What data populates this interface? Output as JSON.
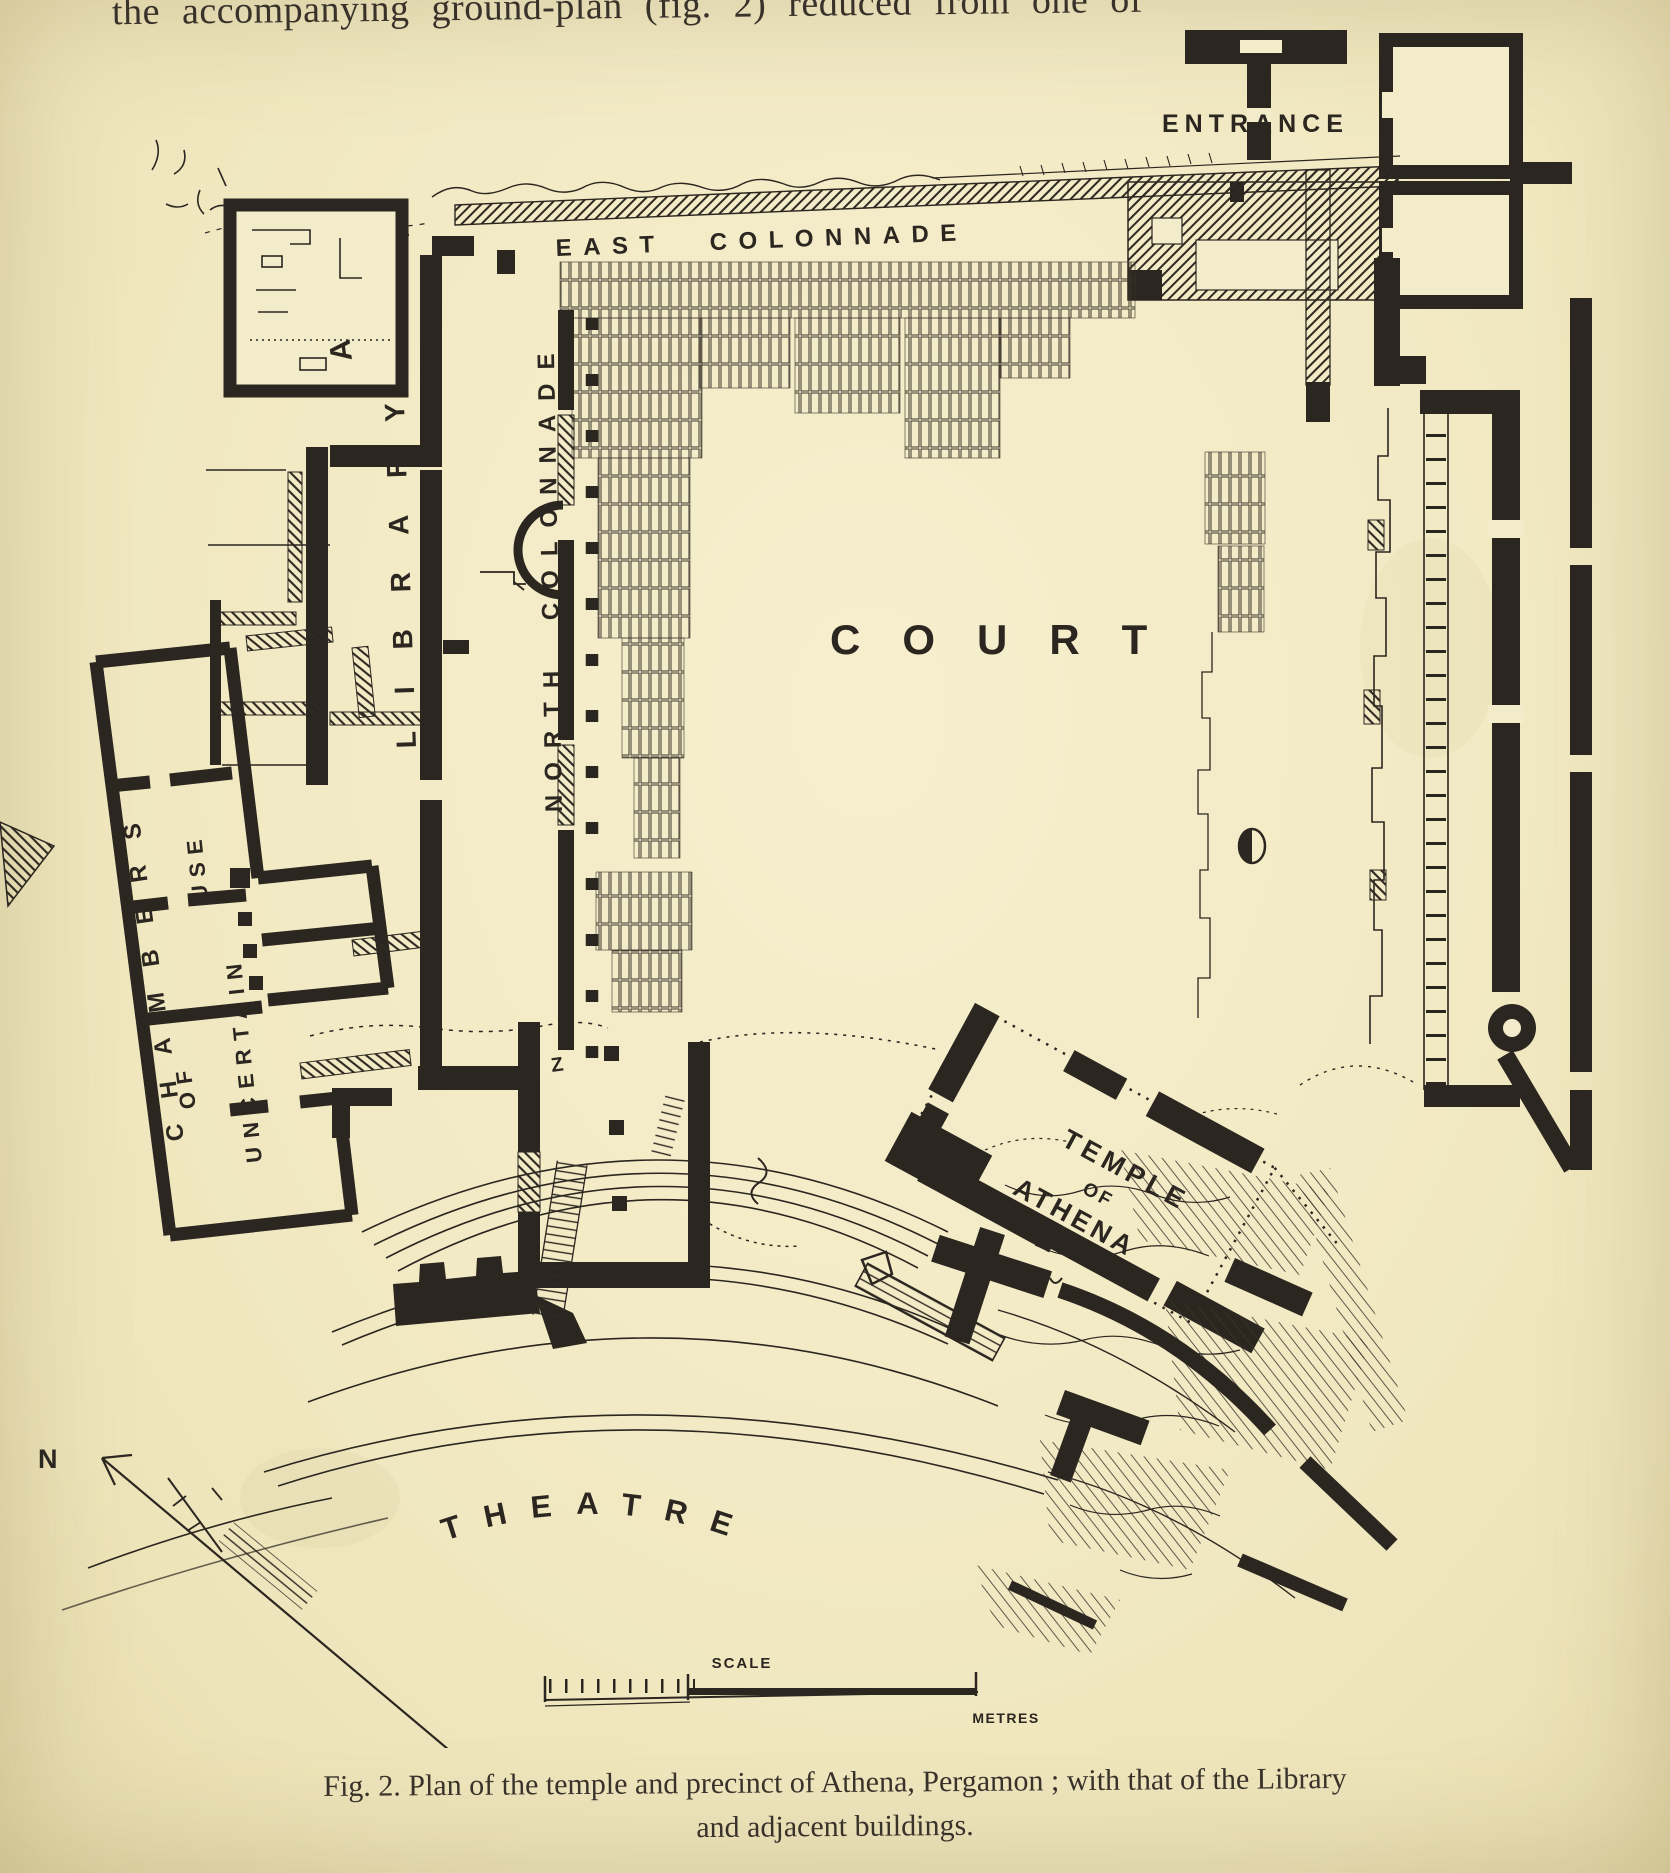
{
  "page": {
    "top_text": "the accompanying ground-plan (fig. 2) reduced from one of",
    "caption": {
      "line1": "Fig. 2.  Plan of the temple and precinct of Athena, Pergamon ; with that of the Library",
      "line2": "and adjacent buildings."
    }
  },
  "plan": {
    "labels": {
      "entrance": "ENTRANCE",
      "east_colonnade": "EAST COLONNADE",
      "north_colonnade": "NORTH COLONNADE",
      "library": "LIBRARY",
      "room_a": "A",
      "court": "COURT",
      "chambers": "CHAMBERS",
      "chambers_of": "OF",
      "chambers_uncertain": "UNCERTAIN",
      "chambers_use": "USE",
      "temple_line1": "TEMPLE",
      "temple_line2": "OF",
      "temple_line3": "ATHENA",
      "theatre": "THEATRE",
      "compass_north": "N",
      "scale": "SCALE",
      "metres": "METRES",
      "z_mark": "Z"
    },
    "colors": {
      "paper": "#f2eac4",
      "ink": "#2b2620"
    }
  }
}
